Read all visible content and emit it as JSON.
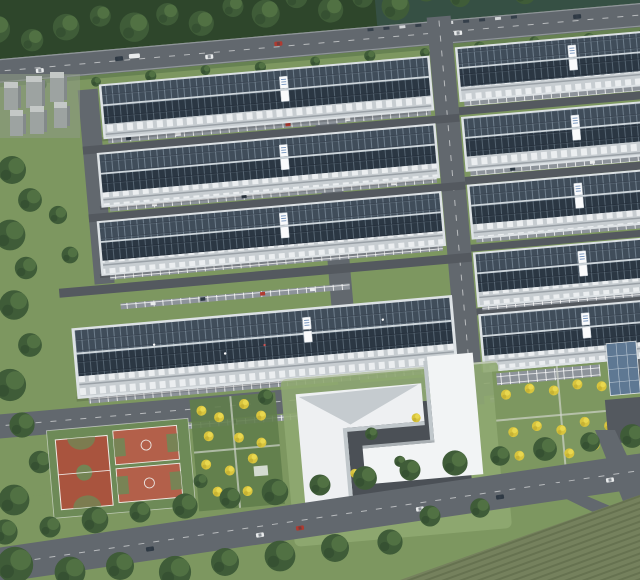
{
  "meta": {
    "type": "architectural-aerial-rendering",
    "title": "Aerial rendering of an industrial park campus with solar-panel rooftops, internal road grid, basketball courts, white office complex, yellow-tree gardens and tree-lined boundary roads",
    "time_of_day": "daytime",
    "visible_text": "none"
  },
  "colors": {
    "grass": "#7d9760",
    "grass_light": "#8fa871",
    "grass_dark": "#617d4b",
    "forest": "#3f5c38",
    "forest_dark": "#2e462b",
    "tree_light": "#5d7f4b",
    "road_dark": "#54595f",
    "road_mid": "#62686e",
    "road_light": "#8d939a",
    "sidewalk": "#b6bcc0",
    "solar_dark": "#27323f",
    "solar_mid": "#32404e",
    "solar_line": "#93a7b8",
    "roof_edge": "#dde2e5",
    "wall": "#c7cdd1",
    "window": "#edf0f1",
    "white_building": "#eef0f2",
    "building_shade": "#c0c7cb",
    "courtyard": "#4b5056",
    "court_red": "#a9543e",
    "court_red_light": "#b3604a",
    "court_green": "#6d8a57",
    "yellow_tree": "#d8c43d",
    "yellow_tree_light": "#e9d84f",
    "yellow_tree_dark": "#b9a52e",
    "carport_blue": "#5e7893",
    "haze_blue": "#4d6d86",
    "field": "#75815d",
    "field_line": "#606c4a",
    "car_white": "#e9ebec",
    "car_dark": "#2e3944",
    "car_red": "#b03a30"
  },
  "scene": {
    "campus": {
      "factory_buildings_left_column": 4,
      "factory_buildings_right_column": 5,
      "rooftops": "dark solar-panel arrays with white ridge and border",
      "roof_label_tags": "small white illegible tags on each roof",
      "tilt_degrees": -5
    },
    "amenities": {
      "basketball_courts": 3,
      "office_buildings": 2,
      "gardens_with_yellow_trees": 2,
      "solar_carport": 1,
      "utility_blocks_top_left": 6
    },
    "roads": {
      "top_boundary_road": "tree-lined with traffic",
      "bottom_boundary_road": "tree-lined dual direction with traffic",
      "internal_grid": "vertical and horizontal service roads with parking stalls"
    }
  }
}
